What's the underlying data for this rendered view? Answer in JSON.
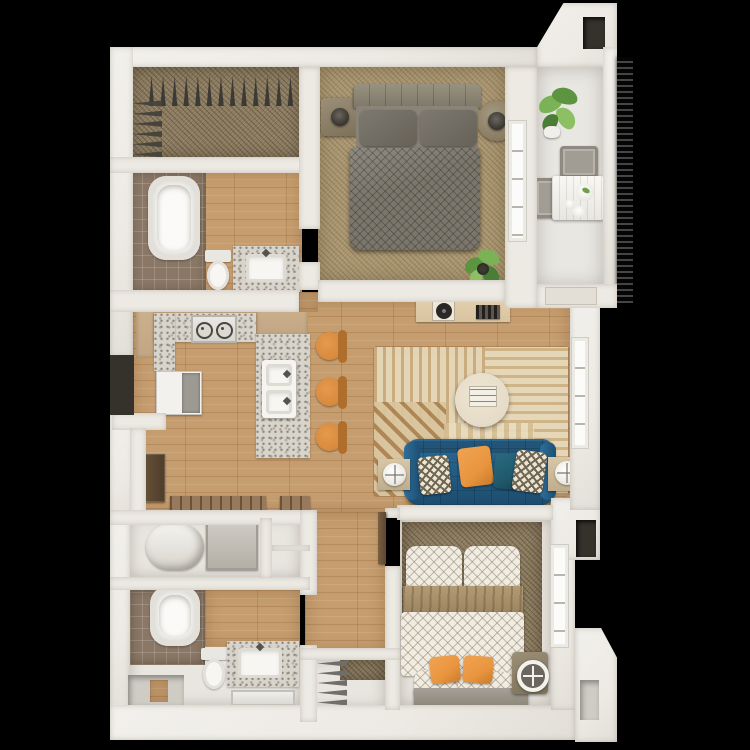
{
  "scene": {
    "type": "3d-floorplan-top-down-render",
    "background": "black",
    "description": "Top-down 3D architectural rendering of a furnished one-bedroom-plus-den style apartment floor plan on a black background. No text labels are rendered in the image."
  },
  "colors": {
    "wall": "#edeae4",
    "void2": "#35322b",
    "wood": "#c69d6e",
    "carpetTan": "#a8946e",
    "carpetBrown": "#8a7a5e",
    "tile": "#8a7765",
    "granite": "#d8d4cb",
    "cabinetTan": "#c2a684",
    "sofa": "#235c82",
    "stool": "#d8893c",
    "pillowOrange": "#e9953f",
    "pillowTeal": "#20596d",
    "rugBase": "#dccbaa",
    "consoleWood": "#d9c4a1",
    "coffeeTable": "#e5dbc8",
    "blanketTan": "#a28b66",
    "bedGray": "#7b766b"
  },
  "counts": {
    "closet_top_hangers": 13,
    "closet_side_hangers": 6,
    "wardrobe_hangers": 5,
    "bar_stools": 3,
    "sofa_pillows": 4,
    "balcony_chairs": 2
  },
  "rooms": [
    {
      "id": "walk-in-closet",
      "label": "Walk-in closet",
      "furniture": [
        "hanging rods with hangers",
        "carpet"
      ]
    },
    {
      "id": "bathroom-1",
      "label": "Bathroom 1",
      "furniture": [
        "bathtub",
        "toilet",
        "vanity with sink",
        "tile + wood floor"
      ]
    },
    {
      "id": "bedroom-1",
      "label": "Bedroom 1",
      "furniture": [
        "queen bed with gray bedding",
        "two nightstands with lamps",
        "potted plant",
        "window"
      ]
    },
    {
      "id": "balcony",
      "label": "Balcony",
      "furniture": [
        "bistro table",
        "two chairs",
        "potted plant",
        "privacy railing"
      ]
    },
    {
      "id": "kitchen",
      "label": "Kitchen",
      "furniture": [
        "L-counter with granite top",
        "cooktop",
        "refrigerator",
        "island peninsula with double sink",
        "three orange bar stools",
        "lower cabinet",
        "slat benches"
      ]
    },
    {
      "id": "living-room",
      "label": "Living room",
      "furniture": [
        "media console with record player and speaker",
        "striped area rug",
        "round coffee table with tray",
        "blue tufted sofa with four pillows",
        "two side tables with round lamps",
        "window"
      ]
    },
    {
      "id": "utility-closet",
      "label": "Utility closet",
      "furniture": [
        "water heater",
        "washer",
        "shelf niches"
      ]
    },
    {
      "id": "bathroom-2",
      "label": "Bathroom 2",
      "furniture": [
        "bathtub",
        "toilet",
        "vanity with sink and mirror"
      ]
    },
    {
      "id": "wardrobe-closet",
      "label": "Wardrobe closet",
      "furniture": [
        "hanging rod with hangers",
        "shelf"
      ]
    },
    {
      "id": "bedroom-2",
      "label": "Bedroom 2",
      "furniture": [
        "bed with white diamond-pattern bedding",
        "tan throw blanket",
        "two orange pillows",
        "foot bench",
        "nightstand with round clock",
        "window"
      ]
    },
    {
      "id": "hallway",
      "label": "Hallway",
      "furniture": [
        "wood flooring"
      ]
    }
  ]
}
